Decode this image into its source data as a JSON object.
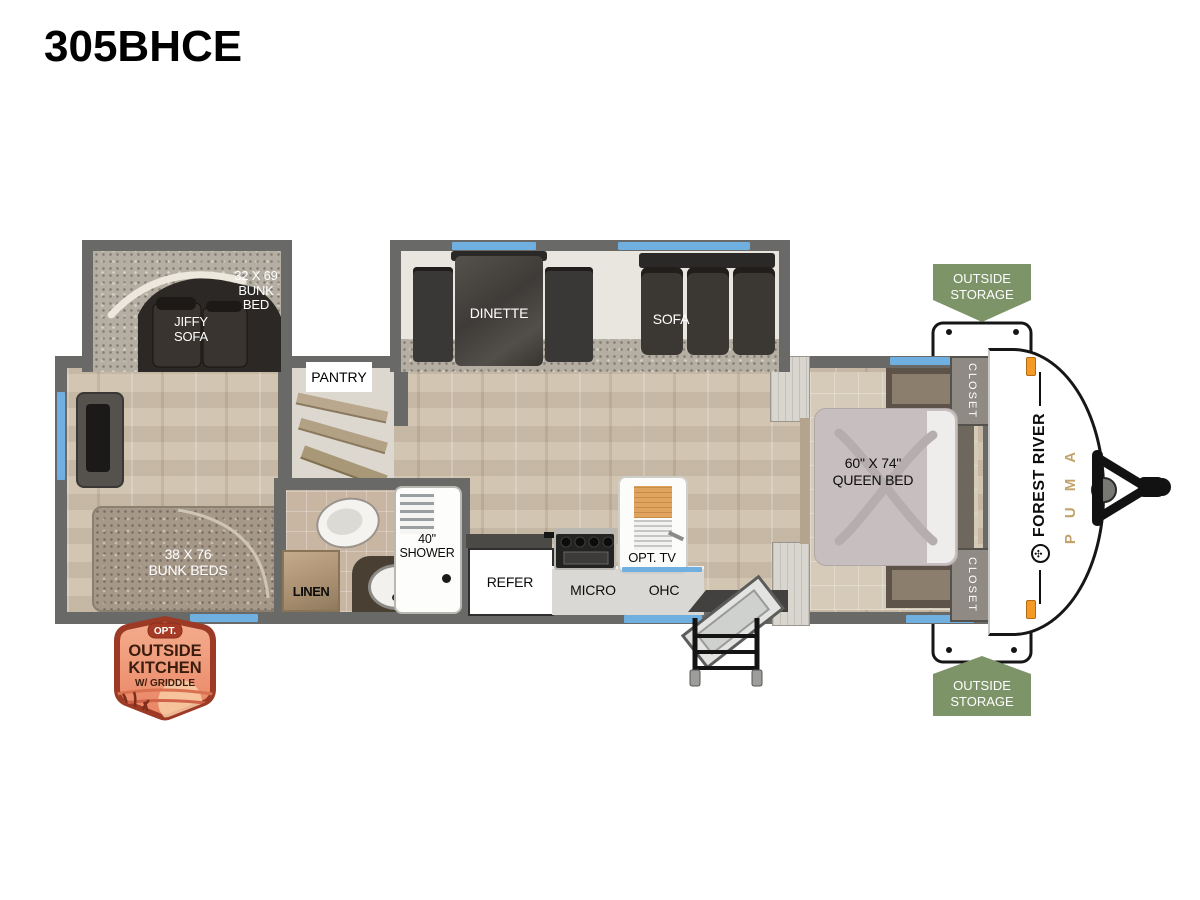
{
  "title": "305BHCE",
  "rooms": {
    "bunk_over_bed": {
      "line1": "32 X 69",
      "line2": "BUNK",
      "line3": "BED"
    },
    "jiffy_sofa": {
      "line1": "JIFFY",
      "line2": "SOFA"
    },
    "dinette": "DINETTE",
    "sofa": "SOFA",
    "pantry": "PANTRY",
    "bunk_beds": {
      "line1": "38 X 76",
      "line2": "BUNK BEDS"
    },
    "linen": "LINEN",
    "shower": {
      "line1": "40\"",
      "line2": "SHOWER"
    },
    "refer": "REFER",
    "micro": "MICRO",
    "ohc": "OHC",
    "opt_tv": "OPT. TV",
    "queen_bed": {
      "line1": "60\" X 74\"",
      "line2": "QUEEN BED"
    },
    "closet_front": "CLOSET",
    "closet_rear": "CLOSET"
  },
  "badges": {
    "outside_storage_top": {
      "line1": "OUTSIDE",
      "line2": "STORAGE"
    },
    "outside_storage_bottom": {
      "line1": "OUTSIDE",
      "line2": "STORAGE"
    },
    "outside_kitchen": {
      "opt": "OPT.",
      "line1": "OUTSIDE",
      "line2": "KITCHEN",
      "line3": "W/ GRIDDLE"
    }
  },
  "brand": {
    "manufacturer": "FOREST RIVER",
    "model": "PUMA"
  },
  "colors": {
    "wall": "#696967",
    "window_accent": "#6fb0e0",
    "storage_badge_green": "#7d9468",
    "kitchen_badge_border": "#9c3a26",
    "kitchen_badge_fill": "#f0997c",
    "puma_gold": "#c2a36b",
    "marker_light_orange": "#f49a26"
  }
}
